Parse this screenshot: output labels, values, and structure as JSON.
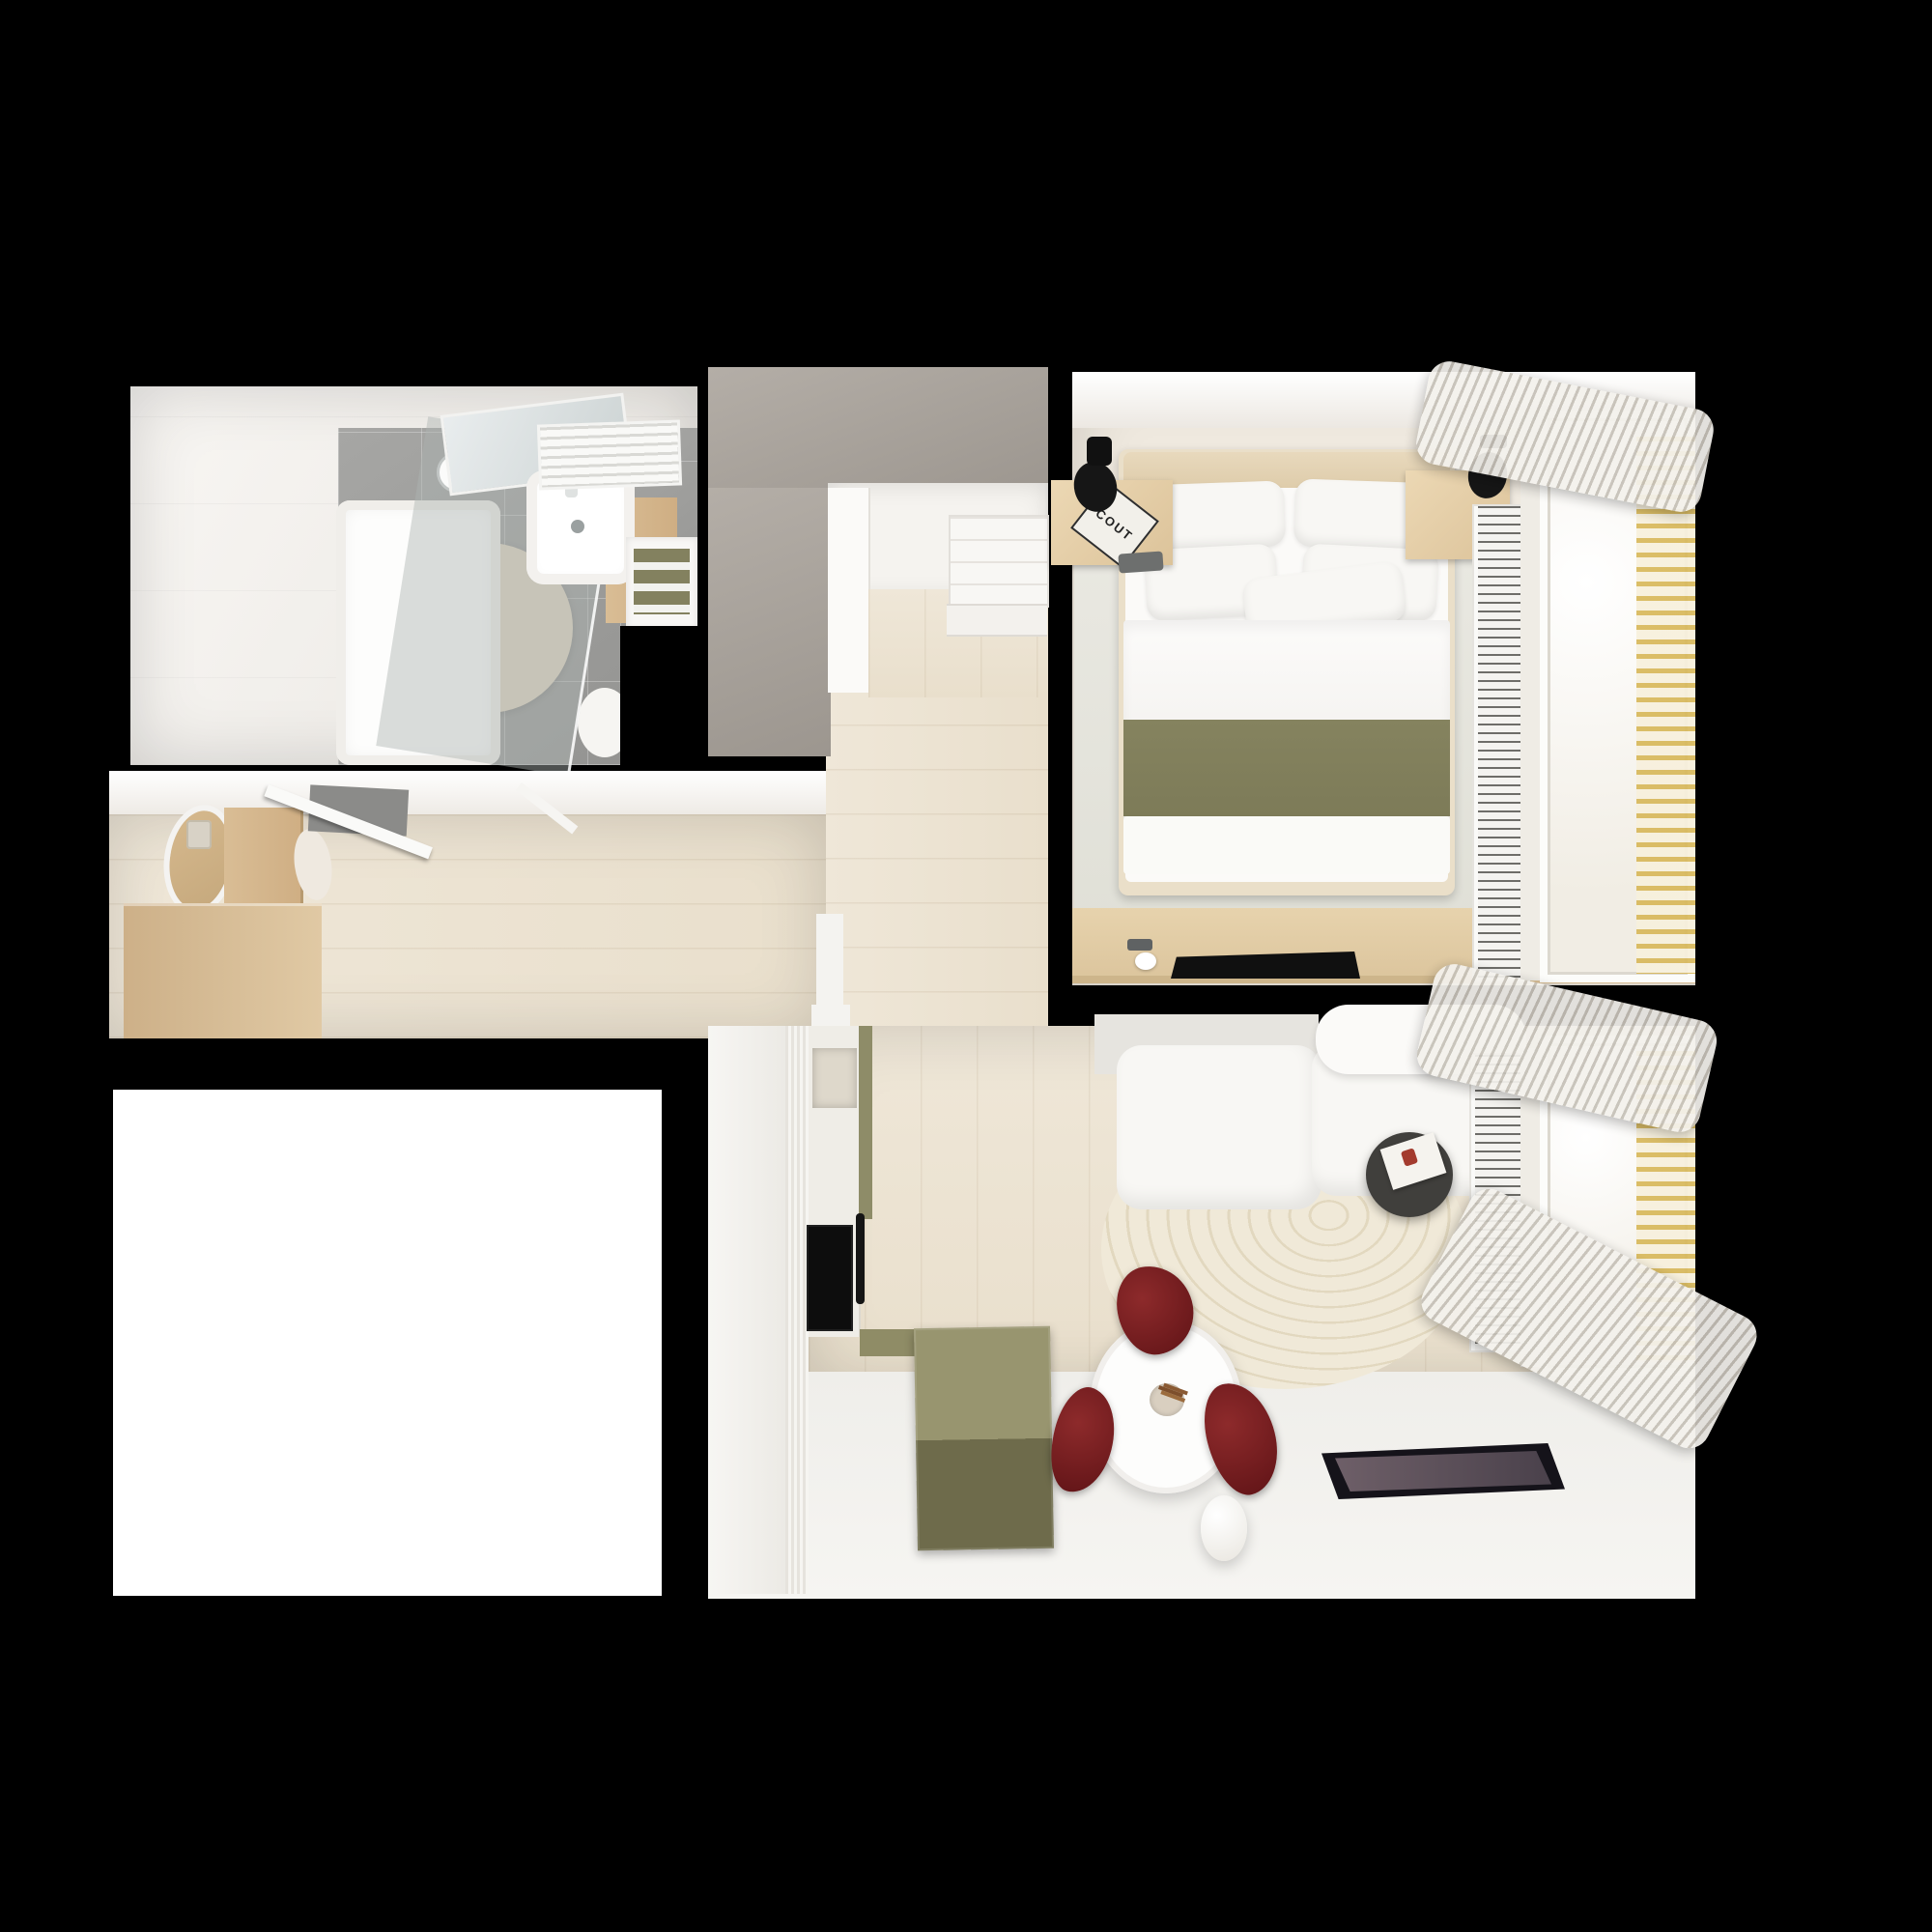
{
  "scene": {
    "title": "Small apartment floor plan, photoreal top-down 3D render",
    "style": "top-view interior render on black background",
    "visible_text": {
      "bedside_book_title": "COUT"
    }
  },
  "colors": {
    "floor_wood": "#e9dfcc",
    "floor_wood_light": "#efe7d8",
    "tile_grey": "#949492",
    "grey_top": "#9c968f",
    "wood_cabinet": "#d9bd95",
    "olive": "#83815f",
    "olive_dark": "#6e6b4b",
    "bed_blanket_olive": "#7d7b58",
    "red_chair": "#5f1316",
    "gold_blind": "#d8b85a",
    "cream_rug": "#efe8d6",
    "beige_rug": "#ddd2bd",
    "sofa_white": "#f8f7f4",
    "tablet_screen": "#6e5f68",
    "background": "#000000"
  },
  "rooms": [
    {
      "name": "bathroom",
      "items": [
        "shower glass panel",
        "shower tray",
        "shower head",
        "mirror",
        "washbasin",
        "wooden vanity",
        "towel radiator",
        "shelf with olive towels",
        "round beige rug",
        "small white rug",
        "grey tile floor"
      ]
    },
    {
      "name": "hallway",
      "items": [
        "entrance door (open)",
        "door mat",
        "oval leaning mirror",
        "light switch plates",
        "wooden laundry cabinet",
        "toilet",
        "low wooden storage cabinet",
        "wall console shelf",
        "wood plank floor"
      ]
    },
    {
      "name": "walk-in-closet",
      "items": [
        "grey wardrobe top",
        "white closet panels",
        "shelf unit with drawers",
        "wood floor"
      ]
    },
    {
      "name": "bedroom",
      "items": [
        "double bed",
        "wood headboard",
        "white pillows",
        "white duvet",
        "olive blanket",
        "left nightstand with COUT book",
        "right nightstand",
        "black wall spotlights",
        "pale area rug",
        "wooden desk",
        "black laptop",
        "phone",
        "white cup",
        "radiator grille",
        "window with sheer curtain",
        "golden venetian blinds",
        "bunched curtains"
      ]
    },
    {
      "name": "living-room-kitchen",
      "items": [
        "white fluted kitchen cabinets",
        "stone counter with sink",
        "black induction cooktop",
        "black oven handle",
        "olive dining bench",
        "round white dining table",
        "plant centerpiece",
        "three dark red chairs",
        "white L-shaped sofa",
        "white console behind sofa",
        "dark round side table with magazine",
        "cream rug with curved stripes",
        "dark tablet on floor",
        "white egg-shaped decor",
        "radiator grille",
        "window with golden blinds",
        "bunched curtains",
        "wood plank floor",
        "white floor area"
      ]
    },
    {
      "name": "empty-room",
      "items": [
        "unfurnished white room"
      ]
    }
  ]
}
